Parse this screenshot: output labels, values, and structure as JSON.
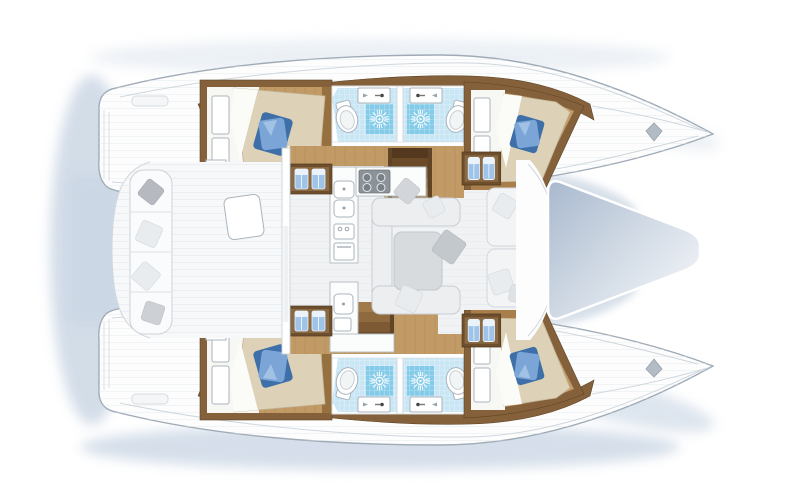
{
  "meta": {
    "diagram": "catamaran-interior-floor-plan",
    "orientation": "bows-right-sterns-left"
  },
  "colors": {
    "hull_fill": "#fdfdfe",
    "hull_stroke": "#9fabb6",
    "trim_wood": "#84613a",
    "trim_wood_dark": "#6e4f2d",
    "floor_wood": "#c19a66",
    "floor_wood_dark": "#a87f4c",
    "bath_floor": "#c9e6f5",
    "bath_tile": "#83cbe8",
    "fixture_stroke": "#aab4bd",
    "bed_sheet": "#f7f7f4",
    "bed_duvet": "#ddd1b8",
    "pillow_blue": "#7ba5d6",
    "pillow_blue_dark": "#3f6fa8",
    "towel_blue": "#9fc4e8",
    "salon_floor": "#f0f2f4",
    "sofa_fill": "#eceef0",
    "sofa_stroke": "#c9ced4",
    "table_fill": "#d7dbde",
    "pillow_gray": "#c3c8cd",
    "counter_fill": "#fbfcfc",
    "counter_stroke": "#b7bfc6",
    "stove_fill": "#8b9298",
    "cleat_gray": "#b3bcc4",
    "shadow_blue": "#bccbdd",
    "tramp_dark": "#a9b9cf",
    "tramp_light": "#f4f6f9"
  },
  "fixtures": {
    "double_cabins": 4,
    "bathrooms": 4,
    "shower_cells": 4,
    "toilets": 4,
    "bathroom_sinks": 4,
    "stove_burners": 4,
    "galley_sinks": 2,
    "companionway_stairs": 2,
    "towel_cabinets": 4,
    "cockpit_cushions": 4,
    "tables": 2
  },
  "icons": [
    "shower-starburst-icon",
    "toilet-icon",
    "sink-faucet-icon",
    "stove-burners-icon",
    "towel-pair-icon",
    "bow-cleat-icon",
    "pillow-icon"
  ]
}
